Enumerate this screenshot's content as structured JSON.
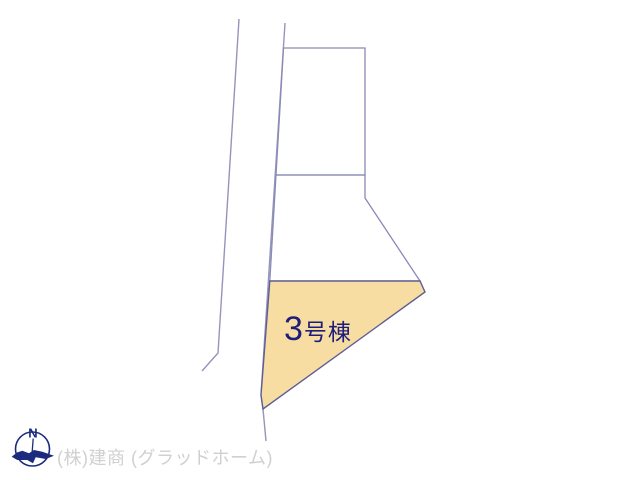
{
  "diagram": {
    "building_label": {
      "number": "3",
      "suffix": "号棟"
    },
    "compass": {
      "north_label": "N"
    },
    "footer": {
      "company_text": "(株)建商 (グラッドホーム)"
    }
  },
  "colors": {
    "background": "#ffffff",
    "road_line": "#9494bd",
    "plot_line": "#8a8ab5",
    "highlight_fill": "#f8dda3",
    "highlight_border": "#5e5e95",
    "label_text": "#1d1d7c",
    "footer_text": "#d0d0d0",
    "compass_color": "#1c2b7d"
  }
}
